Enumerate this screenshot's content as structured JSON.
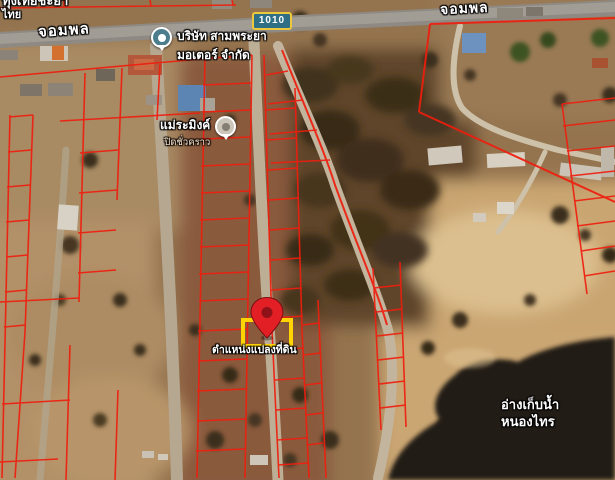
{
  "map": {
    "top_left_place": {
      "line1": "ทุ่งเทียชะยา",
      "line2": "ไทย"
    },
    "roads": {
      "name_left": "จอมพล",
      "name_right": "จอมพล",
      "route_number": "1010"
    },
    "business_poi": {
      "name_line1": "บริษัท สามพระยา",
      "name_line2": "มอเตอร์ จำกัด",
      "icon": "map-pin-icon-teal"
    },
    "closed_poi": {
      "name": "แม่ระมิงค์",
      "status": "ปิดชั่วคราว",
      "icon": "map-pin-icon-gray"
    },
    "parcel_marker": {
      "label": "ตำแหน่งแปลงที่ดิน",
      "icon": "location-pin-icon"
    },
    "reservoir": {
      "name_line1": "อ่างเก็บน้ำ",
      "name_line2": "หนองไทร"
    },
    "colors": {
      "cadastral_line": "#ef1e0e",
      "parcel_highlight": "#ffd400",
      "pin": "#e31f26",
      "route_badge_bg": "#2e6f86",
      "route_badge_border": "#edc73c",
      "poi_teal": "#4b7d8d",
      "water": "#221a12"
    }
  }
}
